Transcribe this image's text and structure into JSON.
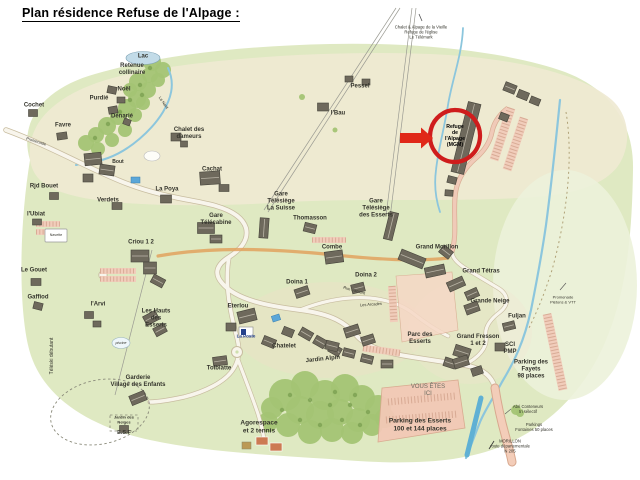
{
  "page": {
    "title": "Plan résidence Refuse de l'Alpage :"
  },
  "palette": {
    "paper": "#ffffff",
    "green": "#dfe9c2",
    "beige": "#efe9d3",
    "meadow": "#ecf2da",
    "forest": "#a3c474",
    "forestDark": "#7ea254",
    "river": "#8cc6dd",
    "torrent": "#5fb0d4",
    "roadFill": "#f8f5ec",
    "roadEdge": "#c8bda0",
    "orange": "#e2a25e",
    "parkFill": "#f2c9b6",
    "parkEdge": "#d8a88e",
    "building": "#6e695c",
    "buildingEdge": "#45433a",
    "label": "#34342c",
    "red": "#cf1d1d",
    "redArrow": "#e02818"
  },
  "map": {
    "highlight": {
      "text": "Refuge\nde\nl'Alpage\n(MGM)",
      "x": 455,
      "y": 137,
      "fs": 5.2
    },
    "labels": [
      {
        "text": "Lac",
        "x": 143,
        "y": 57,
        "fs": 6,
        "b": 1
      },
      {
        "text": "Retenue\ncollinaire",
        "x": 132,
        "y": 70,
        "fs": 6,
        "b": 1
      },
      {
        "text": "Noël",
        "x": 124,
        "y": 90,
        "fs": 6,
        "b": 1
      },
      {
        "text": "Purdié",
        "x": 99,
        "y": 99,
        "fs": 6,
        "b": 1
      },
      {
        "text": "Dénarié",
        "x": 122,
        "y": 117,
        "fs": 6,
        "b": 1
      },
      {
        "text": "Cochet",
        "x": 34,
        "y": 106,
        "fs": 6,
        "b": 1
      },
      {
        "text": "Favre",
        "x": 63,
        "y": 126,
        "fs": 6,
        "b": 1
      },
      {
        "text": "Chalet des\ndameurs",
        "x": 189,
        "y": 134,
        "fs": 6,
        "b": 1
      },
      {
        "text": "Pessel",
        "x": 360,
        "y": 87,
        "fs": 6,
        "b": 1
      },
      {
        "text": "l'Bau",
        "x": 338,
        "y": 114,
        "fs": 6,
        "b": 1
      },
      {
        "text": "Bout",
        "x": 118,
        "y": 163,
        "fs": 5,
        "b": 1
      },
      {
        "text": "Rjd Bouet",
        "x": 44,
        "y": 187,
        "fs": 6,
        "b": 1
      },
      {
        "text": "Verdets",
        "x": 108,
        "y": 201,
        "fs": 6,
        "b": 1
      },
      {
        "text": "La Poya",
        "x": 167,
        "y": 190,
        "fs": 6,
        "b": 1
      },
      {
        "text": "Cachat",
        "x": 212,
        "y": 170,
        "fs": 6,
        "b": 1
      },
      {
        "text": "l'Ubiat",
        "x": 36,
        "y": 215,
        "fs": 6,
        "b": 1
      },
      {
        "text": "Le Gouet",
        "x": 34,
        "y": 271,
        "fs": 6,
        "b": 1
      },
      {
        "text": "Gaffiod",
        "x": 38,
        "y": 298,
        "fs": 6,
        "b": 1
      },
      {
        "text": "l'Arvi",
        "x": 98,
        "y": 305,
        "fs": 6,
        "b": 1
      },
      {
        "text": "Criou 1 2",
        "x": 141,
        "y": 243,
        "fs": 6,
        "b": 1
      },
      {
        "text": "Les Hauts\ndes\nEsserts",
        "x": 156,
        "y": 319,
        "fs": 6,
        "b": 1
      },
      {
        "text": "Gare\nTélécabine",
        "x": 216,
        "y": 220,
        "fs": 6,
        "b": 1
      },
      {
        "text": "Gare\nTélésiège\nLa Suisse",
        "x": 281,
        "y": 202,
        "fs": 6,
        "b": 1
      },
      {
        "text": "Thomasson",
        "x": 310,
        "y": 219,
        "fs": 6,
        "b": 1
      },
      {
        "text": "Combe",
        "x": 332,
        "y": 248,
        "fs": 6,
        "b": 1
      },
      {
        "text": "Gare\nTélésiège\ndes Esserts",
        "x": 376,
        "y": 209,
        "fs": 6,
        "b": 1
      },
      {
        "text": "Doina 1",
        "x": 297,
        "y": 283,
        "fs": 6,
        "b": 1
      },
      {
        "text": "Doina 2",
        "x": 366,
        "y": 276,
        "fs": 6,
        "b": 1
      },
      {
        "text": "Grand Morillon",
        "x": 437,
        "y": 248,
        "fs": 6,
        "b": 1
      },
      {
        "text": "Grand Tétras",
        "x": 481,
        "y": 272,
        "fs": 6,
        "b": 1
      },
      {
        "text": "Grande Neige",
        "x": 490,
        "y": 302,
        "fs": 6,
        "b": 1
      },
      {
        "text": "Fuljan",
        "x": 517,
        "y": 317,
        "fs": 6,
        "b": 1
      },
      {
        "text": "Grand Fresson\n1 et 2",
        "x": 478,
        "y": 341,
        "fs": 6,
        "b": 1
      },
      {
        "text": "SCI\nPMP",
        "x": 510,
        "y": 349,
        "fs": 6,
        "b": 1
      },
      {
        "text": "Parking des\nFayets\n98 places",
        "x": 531,
        "y": 370,
        "fs": 6,
        "b": 1
      },
      {
        "text": "Eterlou",
        "x": 238,
        "y": 307,
        "fs": 6,
        "b": 1
      },
      {
        "text": "La Poste",
        "x": 246,
        "y": 336,
        "fs": 4.5,
        "b": 1,
        "color": "#26428b"
      },
      {
        "text": "Chatelet",
        "x": 284,
        "y": 347,
        "fs": 6,
        "b": 1
      },
      {
        "text": "Rue d'amont",
        "x": 354,
        "y": 291,
        "fs": 4,
        "rot": 16
      },
      {
        "text": "Les Arcades",
        "x": 371,
        "y": 305,
        "fs": 4,
        "rot": -4
      },
      {
        "text": "Jardin Alpin",
        "x": 323,
        "y": 360,
        "fs": 6,
        "b": 1,
        "rot": -6
      },
      {
        "text": "Tolbiatte",
        "x": 219,
        "y": 369,
        "fs": 6,
        "b": 1
      },
      {
        "text": "Parc des\nEsserts",
        "x": 420,
        "y": 339,
        "fs": 6,
        "b": 1
      },
      {
        "text": "VOUS ÊTES\nICI",
        "x": 428,
        "y": 391,
        "fs": 6,
        "color": "#6b6b60"
      },
      {
        "text": "Parking des Esserts\n100 et 144 places",
        "x": 420,
        "y": 425,
        "fs": 6.5,
        "b": 1
      },
      {
        "text": "Agorespace\net 2 tennis",
        "x": 259,
        "y": 427,
        "fs": 6.5,
        "b": 1
      },
      {
        "text": "Garderie\nVillage des Enfants",
        "x": 138,
        "y": 382,
        "fs": 6,
        "b": 1
      },
      {
        "text": "Jardin des\nNeiges",
        "x": 124,
        "y": 420,
        "fs": 4,
        "b": 1
      },
      {
        "text": "E.S.F",
        "x": 124,
        "y": 433,
        "fs": 5.5,
        "b": 1
      },
      {
        "text": "Téléski débutant",
        "x": 53,
        "y": 356,
        "fs": 5,
        "rot": -90
      },
      {
        "text": "Promenade",
        "x": 36,
        "y": 142,
        "fs": 4,
        "rot": 17
      },
      {
        "text": "Le Nant",
        "x": 163,
        "y": 103,
        "fs": 4,
        "rot": 55
      },
      {
        "text": "Chalet & Alpage de la Vieille\nRefuge de l'église\nLe Télémark",
        "x": 421,
        "y": 33,
        "fs": 4.2
      },
      {
        "text": "Promenade\nPiétons & VTT",
        "x": 563,
        "y": 300,
        "fs": 4
      },
      {
        "text": "Abri Conteneurs\ntri sélectif",
        "x": 528,
        "y": 410,
        "fs": 4.2
      },
      {
        "text": "Parkings\nFontaines 50 places",
        "x": 534,
        "y": 428,
        "fs": 4.2
      },
      {
        "text": "MORILLON\nroute départementale\nN 205",
        "x": 510,
        "y": 447,
        "fs": 4.2
      },
      {
        "text": "Navette",
        "x": 56,
        "y": 235,
        "fs": 3.6
      },
      {
        "text": "piscine",
        "x": 121,
        "y": 343,
        "fs": 3.5,
        "italic": 1
      }
    ]
  }
}
